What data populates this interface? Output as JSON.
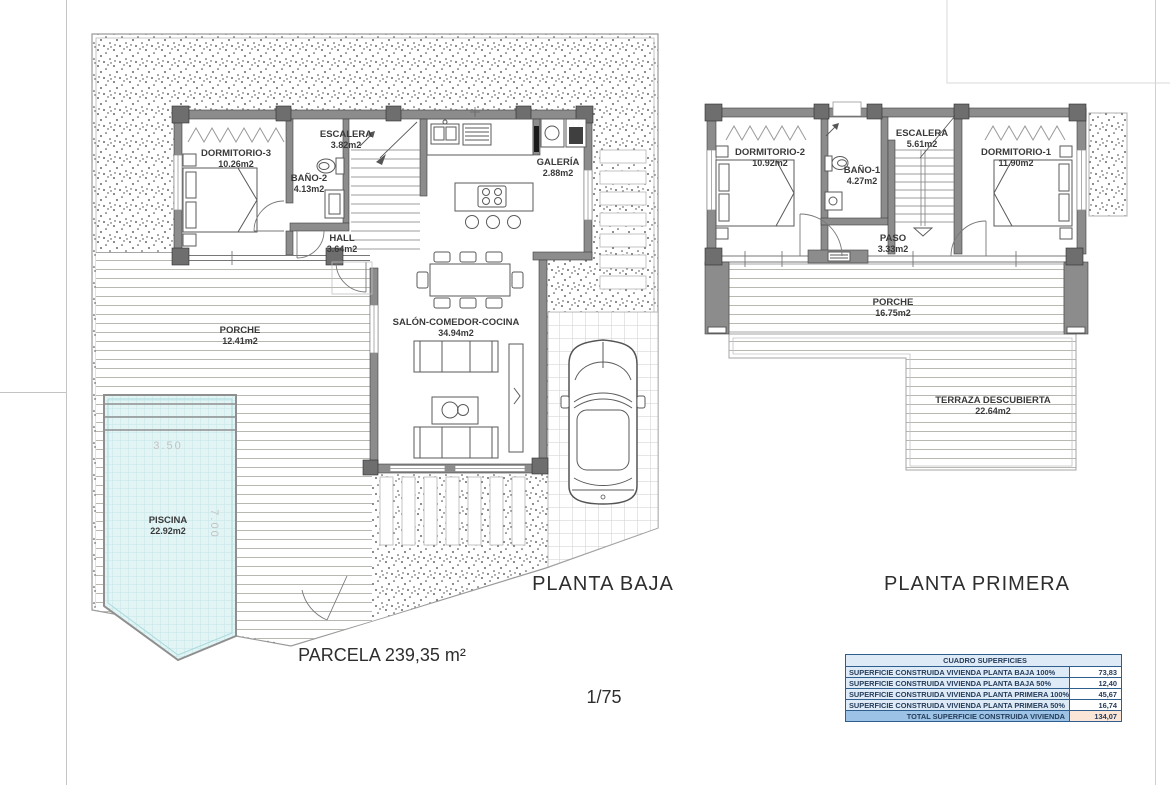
{
  "sheet": {
    "scale_label": "1/75",
    "parcel_label": "PARCELA 239,35 m²"
  },
  "ground_floor": {
    "title": "PLANTA BAJA",
    "rooms": [
      {
        "name": "DORMITORIO-3",
        "area": "10.26m2"
      },
      {
        "name": "BAÑO-2",
        "area": "4.13m2"
      },
      {
        "name": "ESCALERA",
        "area": "3.82m2"
      },
      {
        "name": "GALERÍA",
        "area": "2.88m2"
      },
      {
        "name": "HALL",
        "area": "3.64m2"
      },
      {
        "name": "SALÓN-COMEDOR-COCINA",
        "area": "34.94m2"
      },
      {
        "name": "PORCHE",
        "area": "12.41m2"
      },
      {
        "name": "PISCINA",
        "area": "22.92m2"
      }
    ],
    "pool_dims": {
      "width": "3.50",
      "length": "7.00"
    }
  },
  "first_floor": {
    "title": "PLANTA PRIMERA",
    "rooms": [
      {
        "name": "DORMITORIO-2",
        "area": "10.92m2"
      },
      {
        "name": "BAÑO-1",
        "area": "4.27m2"
      },
      {
        "name": "ESCALERA",
        "area": "5.61m2"
      },
      {
        "name": "DORMITORIO-1",
        "area": "11.90m2"
      },
      {
        "name": "PASO",
        "area": "3.33m2"
      },
      {
        "name": "PORCHE",
        "area": "16.75m2"
      },
      {
        "name": "TERRAZA DESCUBIERTA",
        "area": "22.64m2"
      }
    ]
  },
  "areas_table": {
    "title": "CUADRO SUPERFICIES",
    "rows": [
      {
        "label": "SUPERFICIE CONSTRUIDA VIVIENDA PLANTA BAJA 100%",
        "value": "73,83"
      },
      {
        "label": "SUPERFICIE CONSTRUIDA VIVIENDA PLANTA BAJA 50%",
        "value": "12,40"
      },
      {
        "label": "SUPERFICIE CONSTRUIDA VIVIENDA PLANTA PRIMERA 100%",
        "value": "45,67"
      },
      {
        "label": "SUPERFICIE CONSTRUIDA VIVIENDA PLANTA PRIMERA 50%",
        "value": "16,74"
      }
    ],
    "total": {
      "label": "TOTAL SUPERFICIE CONSTRUIDA VIVIENDA",
      "value": "134,07"
    },
    "colors": {
      "header_bg": "#9cc2e5",
      "row_bg": "#deeaf6",
      "total_value_bg": "#fbe5d6",
      "border": "#2e5e8e",
      "text": "#253d5b"
    }
  },
  "drawing_colors": {
    "wall_gray": "#8c8c8c",
    "pool_fill": "#e3f4f5",
    "deck_line": "#b8b8b0",
    "gravel_dot": "#3c3c3c",
    "boundary": "#9a9a9a"
  }
}
